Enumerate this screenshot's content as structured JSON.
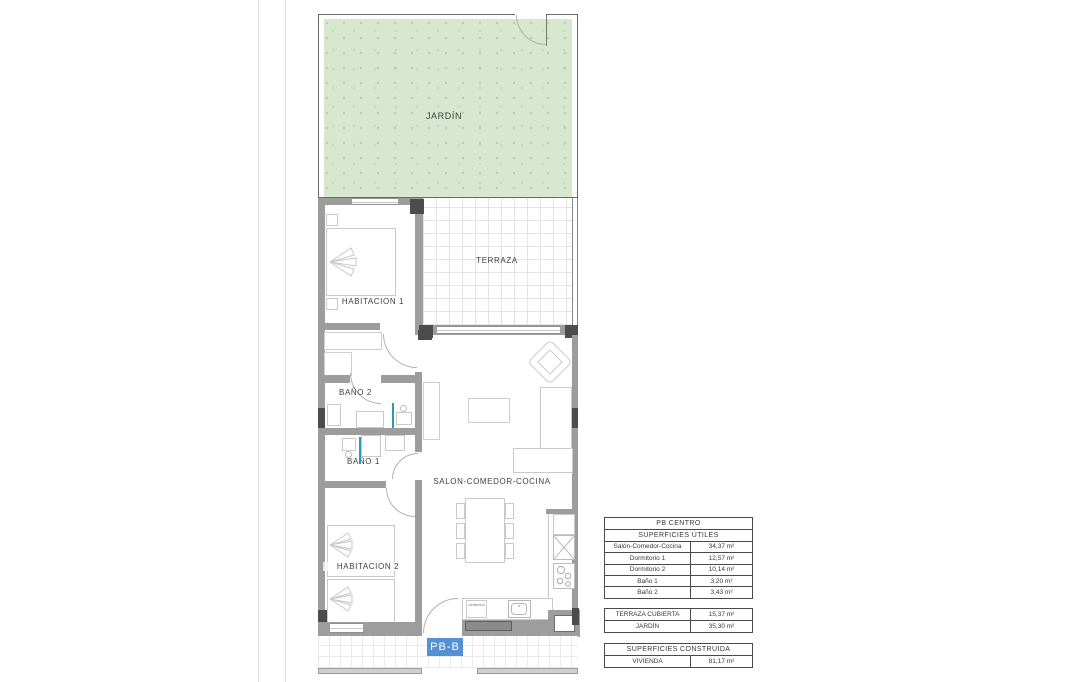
{
  "plan": {
    "unit_label": "PB-B",
    "rooms": {
      "jardin": "JARDÍN",
      "terraza": "TERRAZA",
      "habitacion1": "HABITACION 1",
      "bano2": "BAÑO 2",
      "bano1": "BAÑO 1",
      "habitacion2": "HABITACION 2",
      "salon": "SALON-COMEDOR-COCINA"
    },
    "kitchen_label": "cerámica"
  },
  "tables": {
    "utiles": {
      "title": "PB CENTRO",
      "subtitle": "SUPERFICIES ÚTILES",
      "rows": [
        {
          "label": "Salón-Comedor-Cocina",
          "value": "34,37 m²"
        },
        {
          "label": "Dormitorio 1",
          "value": "12,57 m²"
        },
        {
          "label": "Dormitorio 2",
          "value": "10,14 m²"
        },
        {
          "label": "Baño 1",
          "value": "3,20 m²"
        },
        {
          "label": "Baño 2",
          "value": "3,43 m²"
        }
      ]
    },
    "exterior": {
      "rows": [
        {
          "label": "TERRAZA CUBIERTA",
          "value": "15,37 m²"
        },
        {
          "label": "JARDÍN",
          "value": "35,30 m²"
        }
      ]
    },
    "construida": {
      "title": "SUPERFICIES CONSTRUIDA",
      "rows": [
        {
          "label": "VIVIENDA",
          "value": "81,17 m²"
        }
      ]
    }
  },
  "colors": {
    "accent_blue": "#5591d2",
    "garden_green": "#d7e8cf",
    "wall_gray": "#9d9d9d"
  }
}
